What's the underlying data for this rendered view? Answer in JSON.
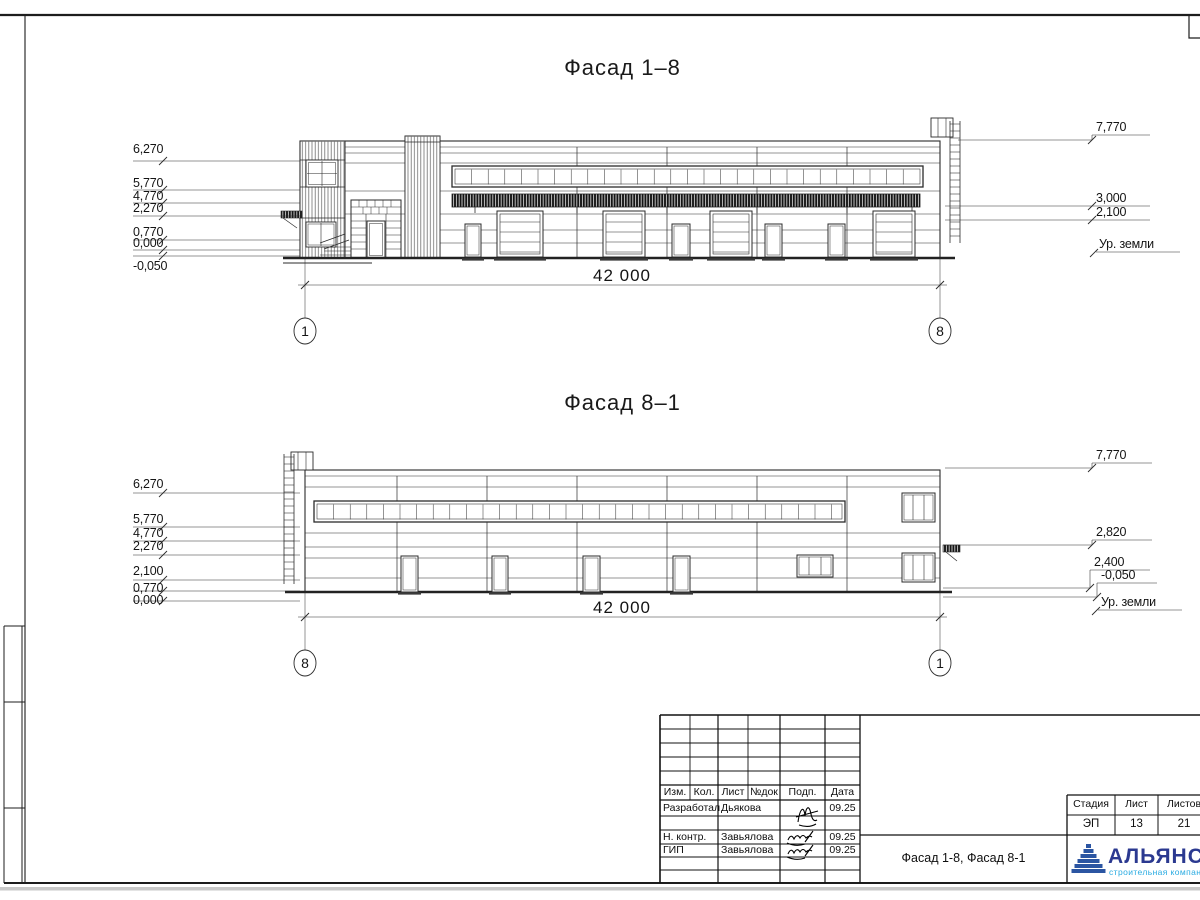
{
  "facade1": {
    "title": "Фасад 1–8",
    "left_marks": [
      "6,270",
      "5,770",
      "4,770",
      "2,270",
      "0,770",
      "0,000",
      "-0,050"
    ],
    "right_marks": [
      "7,770",
      "3,000",
      "2,100"
    ],
    "ground_label": "Ур. земли",
    "dimension": "42 000",
    "axis_left": "1",
    "axis_right": "8"
  },
  "facade2": {
    "title": "Фасад 8–1",
    "left_marks": [
      "6,270",
      "5,770",
      "4,770",
      "2,270",
      "2,100",
      "0,770",
      "0,000"
    ],
    "right_marks": [
      "7,770",
      "2,820",
      "2,400",
      "-0,050"
    ],
    "ground_label": "Ур. земли",
    "dimension": "42 000",
    "axis_left": "8",
    "axis_right": "1"
  },
  "titleblock": {
    "columns": [
      "Изм.",
      "Кол.",
      "Лист",
      "№док",
      "Подп.",
      "Дата"
    ],
    "rows": [
      {
        "role": "Разработал",
        "name": "Дьякова",
        "date": "09.25"
      },
      {
        "role": "Н. контр.",
        "name": "Завьялова",
        "date": "09.25"
      },
      {
        "role": "ГИП",
        "name": "Завьялова",
        "date": "09.25"
      }
    ],
    "doc_title": "Фасад 1-8, Фасад 8-1",
    "stage": {
      "headers": [
        "Стадия",
        "Лист",
        "Листов"
      ],
      "values": [
        "ЭП",
        "13",
        "21"
      ]
    },
    "brand": {
      "name": "АЛЬЯНС",
      "tagline": "строительная компания",
      "color_dark": "#2b3990",
      "color_light": "#29abe2"
    }
  }
}
